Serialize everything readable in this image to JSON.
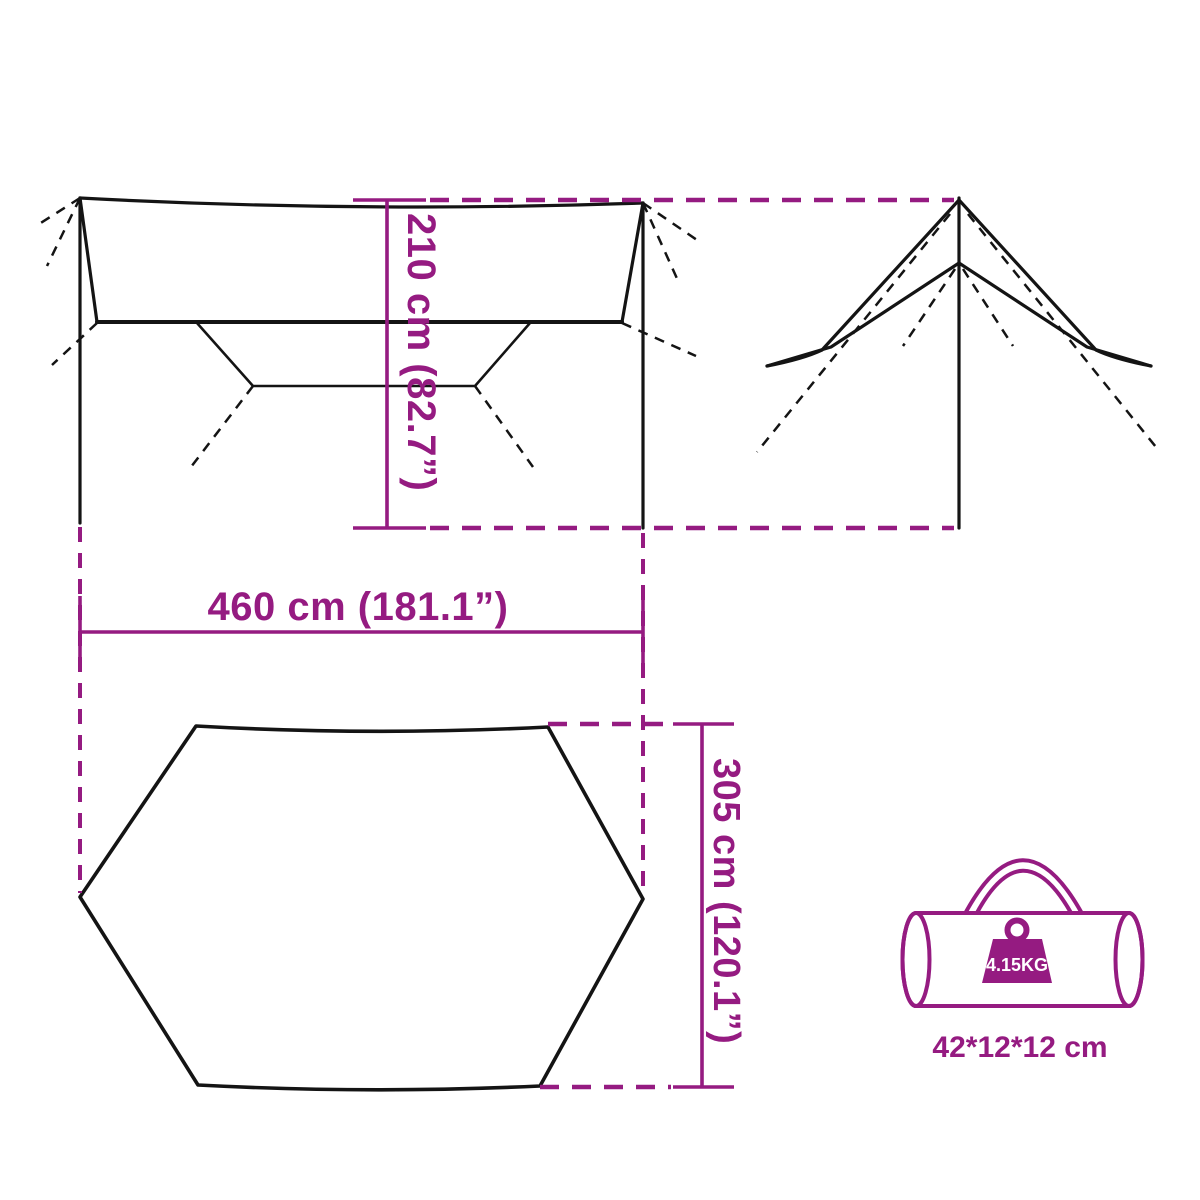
{
  "page": {
    "title": "Tarp dimensions diagram",
    "background": "#ffffff"
  },
  "colors": {
    "accent_magenta": "#951b81",
    "line_black": "#141414",
    "badge_text": "#ffffff",
    "page_bg": "#ffffff"
  },
  "dimensions": {
    "height_label": "210 cm (82.7”)",
    "width_label": "460 cm (181.1”)",
    "depth_label": "305 cm (120.1”)"
  },
  "package": {
    "weight_label": "4.15KG",
    "size_label": "42*12*12 cm"
  }
}
